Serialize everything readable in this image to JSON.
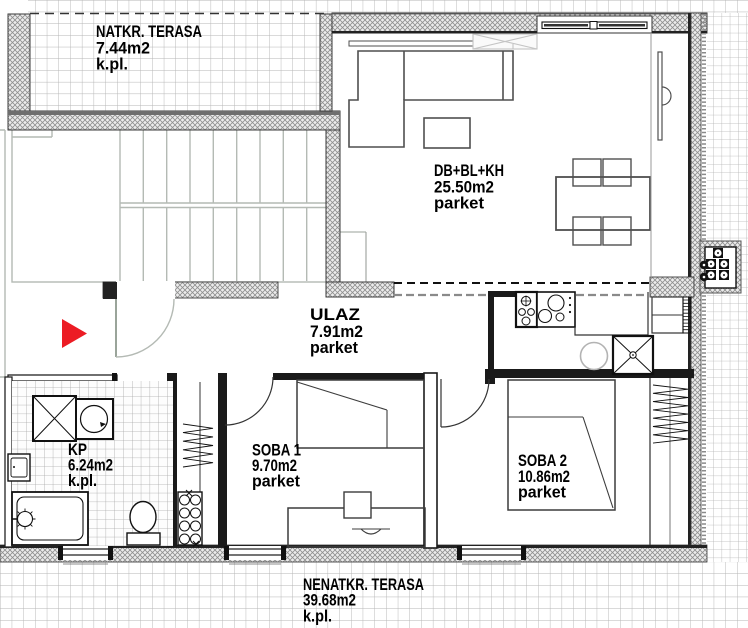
{
  "plan_title": "apartment floor plan",
  "rooms": [
    {
      "name": "NATKR. TERASA",
      "area": "7.44m2",
      "floor": "k.pl."
    },
    {
      "name": "DB+BL+KH",
      "area": "25.50m2",
      "floor": "parket"
    },
    {
      "name": "ULAZ",
      "area": "7.91m2",
      "floor": "parket"
    },
    {
      "name": "KP",
      "area": "6.24m2",
      "floor": "k.pl."
    },
    {
      "name": "SOBA 1",
      "area": "9.70m2",
      "floor": "parket"
    },
    {
      "name": "SOBA 2",
      "area": "10.86m2",
      "floor": "parket"
    },
    {
      "name": "NENATKR. TERASA",
      "area": "39.68m2",
      "floor": "k.pl."
    }
  ],
  "colors": {
    "entry_arrow": "#ec1c24",
    "wall_line": "#222222",
    "stair_lines": "#b4bab4",
    "tile_lines": "#b4b4b4",
    "label_text": "#000000"
  },
  "symbols": [
    "stairs",
    "stove",
    "kitchen-sink",
    "round-table",
    "sink-x-unit",
    "radiator",
    "washing-machine",
    "dryer",
    "bathtub",
    "toilet",
    "wash-basin",
    "wardrobe-rail",
    "bed",
    "desk",
    "chair",
    "sofa",
    "coffee-table",
    "dining-table",
    "ac-unit",
    "entry-arrow",
    "door-swing",
    "window",
    "skylight"
  ]
}
